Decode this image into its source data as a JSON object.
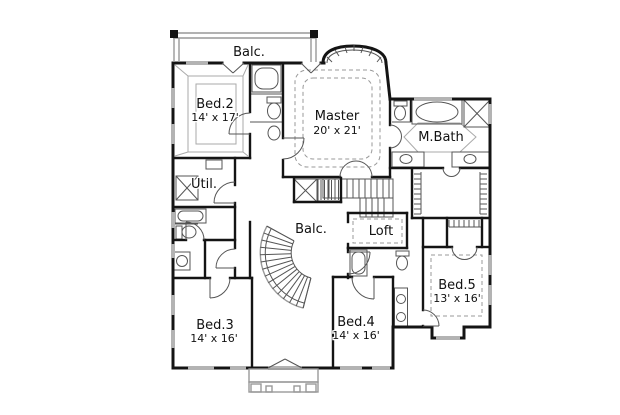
{
  "plan": {
    "type": "second-floor-plan",
    "colors": {
      "wall": "#141414",
      "window_gray": "#b3b3b3",
      "fixture_line": "#555555",
      "ceiling_line": "#aaaaaa",
      "text": "#111111",
      "background": "#ffffff"
    },
    "rooms": {
      "balcony_top": {
        "label": "Balc."
      },
      "bed2": {
        "label": "Bed.2",
        "dims": "14' x 17'"
      },
      "master": {
        "label": "Master",
        "dims": "20' x 21'"
      },
      "mbath": {
        "label": "M.Bath"
      },
      "util": {
        "label": "Util."
      },
      "balcony_mid": {
        "label": "Balc."
      },
      "loft": {
        "label": "Loft"
      },
      "bed5": {
        "label": "Bed.5",
        "dims": "13' x 16'"
      },
      "bed3": {
        "label": "Bed.3",
        "dims": "14' x 16'"
      },
      "bed4": {
        "label": "Bed.4",
        "dims": "14' x 16'"
      }
    },
    "fixtures": [
      "bathtub-bed2-bath",
      "toilet-bed2-bath",
      "sink-bed2-bath",
      "toilet-mbath-wc",
      "oval-tub-mbath",
      "shower-mbath",
      "sink-mbath-left",
      "sink-mbath-right",
      "washer-util",
      "bathtub-left-bath",
      "toilet-left-bath",
      "sink-left-bath",
      "bathtub-hall-bath",
      "toilet-hall-bath",
      "sink-vanity-1",
      "sink-vanity-2",
      "curved-staircase",
      "straight-staircase",
      "linen-closet",
      "master-closet",
      "bed5-closet",
      "balcony-railing",
      "porch"
    ]
  }
}
